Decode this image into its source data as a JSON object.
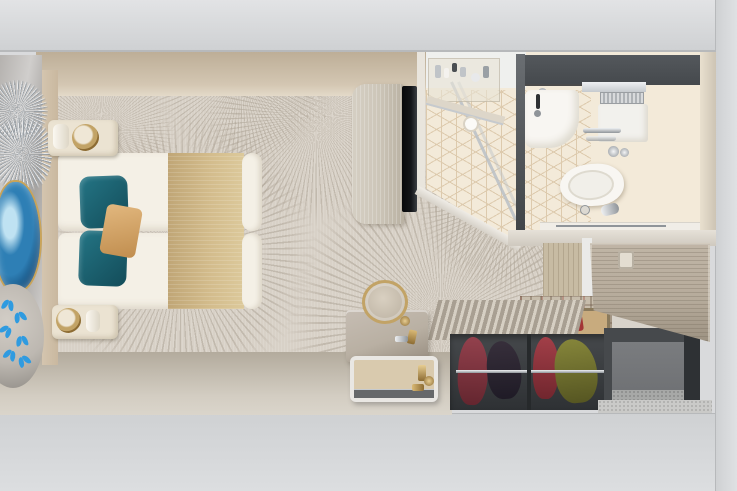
{
  "scene": {
    "label": "Top-down 3D rendering of a cruise ship stateroom: bedroom with double bed, bathroom, wardrobe and entry hall",
    "type": "architectural render, bird's-eye view",
    "rooms": {
      "bedroom": [
        "double bed with white duvet and tan runner",
        "two teal accent pillows",
        "tan throw pillow",
        "two cream nightstands with brass lamps",
        "marble feature wall",
        "silver leaf wall decor",
        "blue agate artwork",
        "planter with blue butterflies",
        "fan-patterned carpet",
        "TV cabinet with wall-mounted TV",
        "vanity desk",
        "round brass stool",
        "amenity tray"
      ],
      "bathroom": [
        "glass shower with dark wall panel",
        "vanity shelf with toiletries",
        "washbasin with faucet",
        "round countertop sink",
        "wall-hung toilet with flush plate",
        "chrome towel rails",
        "cube-mosaic tile floor"
      ],
      "entry_and_closet": [
        "entrance door with handle",
        "open wardrobe with hanging clothes (maroon, black, red, olive)",
        "plaid-lined closet panel",
        "louvered closet top",
        "open luggage nook",
        "speckled entry floor"
      ]
    }
  },
  "palette": {
    "ext-gray": "#d9dadc",
    "ext-gray-dark": "#cfd1d3",
    "wall-line": "#b7b9bb",
    "wall-top": "#d3c6b2",
    "wall-top-dark": "#bdae97",
    "carpet": "#d8d1c7",
    "carpet-fan": "#b0a698",
    "bottom-wall": "#b3ab9d",
    "bottom-wall-light": "#d3cdc2",
    "feature-a": "#b5b2af",
    "feature-b": "#d0cecc",
    "silver": "#9aa0a5",
    "silver-light": "#e6e8ea",
    "geode-mid": "#2e7fb5",
    "geode-deep": "#15507f",
    "geode-ice": "#bfe2f2",
    "geode-gold": "#c9a45a",
    "butterfly": "#2f9be0",
    "planter": "#bdb8b1",
    "planter-dark": "#8f8b85",
    "headboard": "#c9b89f",
    "bed-white": "#f4f0e6",
    "bed-crease": "#ddd6c8",
    "blanket": "#d3bc8c",
    "blanket-dark": "#c0a676",
    "teal": "#247585",
    "teal-dark": "#134c59",
    "throw": "#e2b87f",
    "throw-dark": "#c08d4e",
    "stand": "#ebe3d2",
    "gold": "#c2a366",
    "gold-deep": "#8d6c33",
    "cab-wood": "#cdc6b9",
    "cab-wood-dark": "#b9b1a2",
    "tv": "#131518",
    "bath-floor": "#f3ead9",
    "tile": "#d8c2a2",
    "bath-white": "#eff0ee",
    "bath-dark": "#45494d",
    "chrome": "#c6cace",
    "chrome-dark": "#8f9499",
    "fixture": "#f8f6f2",
    "fixture-shadow": "#dedacf",
    "bath-wall-right": "#e9e0cf",
    "door-wood": "#b6ab9b",
    "door-grain": "#9b9080",
    "entry-wood": "#c7bba3",
    "wardrobe": "#46494c",
    "wardrobe-deep": "#2e3134",
    "louver-a": "#d6cfc3",
    "louver-b": "#a89f92",
    "plaid": "#c7bdac",
    "maroon": "#93414d",
    "maroon-deep": "#64262f",
    "garment-dark": "#372f3b",
    "garment-dark-deep": "#1f1b26",
    "red": "#a23f48",
    "red-deep": "#71262e",
    "olive": "#85853a",
    "olive-deep": "#565622",
    "nook-face": "#707275",
    "nook-floor": "#a7a8a7",
    "entry-floor": "#cacac8",
    "desk": "#b9b0a3",
    "desk-dark": "#978d80",
    "tray-rim": "#e9e7e3",
    "tray-bed": "#d9caae",
    "tray-front": "#66686a",
    "safe-tan": "#c8ab7e",
    "safe-red": "#a33636",
    "sliver": "#d8d3cb",
    "post": "#eaeae8",
    "ledge": "#f0ede7",
    "wall-band": "#e6e1d8"
  }
}
